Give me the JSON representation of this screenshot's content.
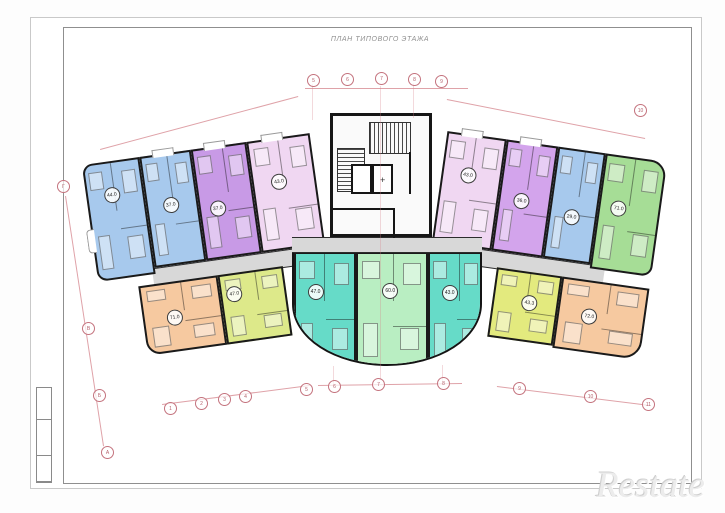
{
  "sheet": {
    "title": "ПЛАН ТИПОВОГО ЭТАЖА"
  },
  "watermark": {
    "text": "Restate"
  },
  "colors": {
    "wall": "#1a1a1a",
    "corridor": "#d8d8d8",
    "dimension": "#c9646e",
    "blue": "#a7c9ed",
    "purple": "#c89ae6",
    "pink": "#f0d7f2",
    "green": "#a6dd96",
    "orange": "#f6c9a0",
    "lime": "#dde98a",
    "teal": "#66dbc8",
    "mint": "#b9eec2"
  },
  "plan": {
    "wings": {
      "left": {
        "x": 95,
        "y": 132,
        "w": 230,
        "h": 222,
        "rot": -8,
        "origin": "right center"
      },
      "right": {
        "x": 432,
        "y": 130,
        "w": 222,
        "h": 222,
        "rot": 8,
        "origin": "left center"
      }
    },
    "corridors": [
      {
        "wing": "left",
        "x": 55,
        "y": 112,
        "w": 175,
        "h": 18
      },
      {
        "wing": "right",
        "x": 0,
        "y": 112,
        "w": 175,
        "h": 18
      },
      {
        "wing": "global",
        "x": 292,
        "y": 237,
        "w": 190,
        "h": 16
      }
    ],
    "apartments": [
      {
        "id": "apt-1",
        "wing": "left",
        "x": 0,
        "y": 0,
        "w": 58,
        "h": 118,
        "color": "#a7c9ed",
        "area": "44.0",
        "radius": "10px 0 0 10px",
        "lx": 0.42,
        "ly": 0.27,
        "bump": "left"
      },
      {
        "id": "apt-2",
        "wing": "left",
        "x": 58,
        "y": 0,
        "w": 52,
        "h": 112,
        "color": "#a7c9ed",
        "area": "37.0",
        "lx": 0.45,
        "ly": 0.45,
        "bump": "top"
      },
      {
        "id": "apt-3",
        "wing": "left",
        "x": 110,
        "y": 0,
        "w": 56,
        "h": 112,
        "color": "#c89ae6",
        "area": "37.0",
        "lx": 0.3,
        "ly": 0.55,
        "bump": "top"
      },
      {
        "id": "apt-4",
        "wing": "left",
        "x": 166,
        "y": 0,
        "w": 64,
        "h": 112,
        "color": "#f0d7f2",
        "area": "43.0",
        "lx": 0.4,
        "ly": 0.38,
        "bump": "top"
      },
      {
        "id": "apt-5",
        "wing": "left",
        "x": 39,
        "y": 128,
        "w": 80,
        "h": 70,
        "color": "#f6c9a0",
        "area": "71.0",
        "radius": "0 0 0 14px",
        "lx": 0.38,
        "ly": 0.5
      },
      {
        "id": "apt-6",
        "wing": "left",
        "x": 119,
        "y": 128,
        "w": 66,
        "h": 70,
        "color": "#dde98a",
        "area": "47.0",
        "lx": 0.18,
        "ly": 0.28
      },
      {
        "id": "apt-7",
        "wing": "right",
        "x": 0,
        "y": 0,
        "w": 60,
        "h": 112,
        "color": "#f0d7f2",
        "area": "43.0",
        "lx": 0.42,
        "ly": 0.35,
        "bump": "top"
      },
      {
        "id": "apt-8",
        "wing": "right",
        "x": 60,
        "y": 0,
        "w": 52,
        "h": 112,
        "color": "#d3a4ec",
        "area": "36.0",
        "lx": 0.42,
        "ly": 0.52,
        "bump": "top"
      },
      {
        "id": "apt-9",
        "wing": "right",
        "x": 112,
        "y": 0,
        "w": 48,
        "h": 112,
        "color": "#a7c9ed",
        "area": "29.0",
        "lx": 0.45,
        "ly": 0.6
      },
      {
        "id": "apt-10",
        "wing": "right",
        "x": 160,
        "y": 0,
        "w": 62,
        "h": 116,
        "color": "#a6dd96",
        "area": "71.0",
        "radius": "0 16px 10px 0",
        "lx": 0.3,
        "ly": 0.45
      },
      {
        "id": "apt-11",
        "wing": "right",
        "x": 68,
        "y": 128,
        "w": 66,
        "h": 70,
        "color": "#e3ea7e",
        "area": "43.3",
        "lx": 0.55,
        "ly": 0.42
      },
      {
        "id": "apt-12",
        "wing": "right",
        "x": 134,
        "y": 128,
        "w": 88,
        "h": 72,
        "color": "#f6c9a0",
        "area": "72.0",
        "radius": "0 0 18px 0",
        "lx": 0.35,
        "ly": 0.48
      },
      {
        "id": "apt-13",
        "wing": "center",
        "x": 0,
        "y": 0,
        "w": 62,
        "h": 116,
        "color": "#66dbc8",
        "area": "47.0",
        "lx": 0.32,
        "ly": 0.33
      },
      {
        "id": "apt-14",
        "wing": "center",
        "x": 62,
        "y": 0,
        "w": 72,
        "h": 116,
        "color": "#b9eec2",
        "area": "60.0",
        "lx": 0.46,
        "ly": 0.32
      },
      {
        "id": "apt-15",
        "wing": "center",
        "x": 134,
        "y": 0,
        "w": 56,
        "h": 116,
        "color": "#66dbc8",
        "area": "43.0",
        "lx": 0.36,
        "ly": 0.34
      }
    ],
    "core": {
      "lifts": [
        {
          "x": 18,
          "y": 48,
          "w": 21,
          "h": 30
        },
        {
          "x": 39,
          "y": 48,
          "w": 21,
          "h": 30,
          "cross": true
        }
      ],
      "walls": [
        {
          "x": 0,
          "y": 92,
          "w": 62,
          "h": 2
        },
        {
          "x": 60,
          "y": 92,
          "w": 2,
          "h": 30
        },
        {
          "x": 76,
          "y": 36,
          "w": 2,
          "h": 42
        }
      ]
    }
  },
  "axes": {
    "bubbles": [
      {
        "label": "1",
        "x": 170,
        "y": 408
      },
      {
        "label": "2",
        "x": 201,
        "y": 403
      },
      {
        "label": "3",
        "x": 224,
        "y": 399
      },
      {
        "label": "4",
        "x": 245,
        "y": 396
      },
      {
        "label": "5",
        "x": 306,
        "y": 389
      },
      {
        "label": "6",
        "x": 334,
        "y": 386
      },
      {
        "label": "7",
        "x": 378,
        "y": 384
      },
      {
        "label": "8",
        "x": 443,
        "y": 383
      },
      {
        "label": "9",
        "x": 519,
        "y": 388
      },
      {
        "label": "10",
        "x": 590,
        "y": 396
      },
      {
        "label": "11",
        "x": 648,
        "y": 404
      },
      {
        "label": "5",
        "x": 313,
        "y": 80
      },
      {
        "label": "6",
        "x": 347,
        "y": 79
      },
      {
        "label": "7",
        "x": 381,
        "y": 78
      },
      {
        "label": "8",
        "x": 414,
        "y": 79
      },
      {
        "label": "9",
        "x": 441,
        "y": 81
      },
      {
        "label": "10",
        "x": 640,
        "y": 110
      },
      {
        "label": "Г",
        "x": 63,
        "y": 186
      },
      {
        "label": "В",
        "x": 88,
        "y": 328
      },
      {
        "label": "Б",
        "x": 99,
        "y": 395
      },
      {
        "label": "А",
        "x": 107,
        "y": 452
      }
    ],
    "lines": [
      {
        "x1": 100,
        "y1": 149,
        "x2": 298,
        "y2": 96
      },
      {
        "x1": 305,
        "y1": 88,
        "x2": 468,
        "y2": 88
      },
      {
        "x1": 447,
        "y1": 99,
        "x2": 645,
        "y2": 138
      },
      {
        "x1": 66,
        "y1": 196,
        "x2": 104,
        "y2": 446
      },
      {
        "x1": 162,
        "y1": 404,
        "x2": 310,
        "y2": 385
      },
      {
        "x1": 318,
        "y1": 385,
        "x2": 462,
        "y2": 383
      },
      {
        "x1": 497,
        "y1": 386,
        "x2": 650,
        "y2": 405
      },
      {
        "x1": 381,
        "y1": 86,
        "x2": 381,
        "y2": 380,
        "faint": true
      },
      {
        "x1": 334,
        "y1": 366,
        "x2": 334,
        "y2": 385,
        "faint": true
      },
      {
        "x1": 443,
        "y1": 365,
        "x2": 443,
        "y2": 382,
        "faint": true
      },
      {
        "x1": 313,
        "y1": 84,
        "x2": 313,
        "y2": 120,
        "faint": true
      },
      {
        "x1": 414,
        "y1": 83,
        "x2": 414,
        "y2": 118,
        "faint": true
      }
    ]
  }
}
